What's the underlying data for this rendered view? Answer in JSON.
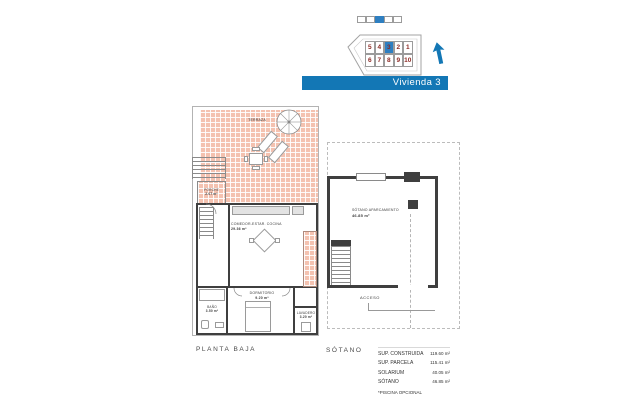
{
  "site_overview": {
    "units_top": [
      "5",
      "4",
      "3",
      "2",
      "1"
    ],
    "units_bottom": [
      "6",
      "7",
      "8",
      "9",
      "10"
    ],
    "highlighted_unit": "3"
  },
  "banner": {
    "label": "Vivienda 3"
  },
  "colors": {
    "accent_blue": "#1377b5",
    "highlight_blue": "#2e7fc1",
    "plot_number_red": "#8c2a24",
    "terrace_hatch": "#f4c2b0",
    "wall_gray": "#3f3f3f"
  },
  "planta_baja": {
    "title": "PLANTA BAJA",
    "terraza_label": "TERRAZA",
    "porche": {
      "name": "PORCHE",
      "area": "2.07 m²"
    },
    "salon": {
      "name": "COMEDOR-ESTAR. COCINA",
      "area": "29.36 m²"
    },
    "dormitorio": {
      "name": "DORMITORIO",
      "area": "9.20 m²"
    },
    "bano": {
      "name": "BAÑO",
      "area": "3.50 m²"
    },
    "lavadero": {
      "name": "LAVADERO",
      "area": "3.20 m²"
    }
  },
  "sotano": {
    "title": "SÓTANO",
    "room": {
      "name": "SÓTANO APARCAMIENTO",
      "area": "46.85 m²"
    },
    "acceso_label": "ACCESO"
  },
  "summary": {
    "rows": [
      {
        "label": "SUP. CONSTRUIDA",
        "value": "119.60 m²"
      },
      {
        "label": "SUP. PARCELA",
        "value": "115.41 m²"
      },
      {
        "label": "SOLARIUM",
        "value": "40.05 m²"
      },
      {
        "label": "SÓTANO",
        "value": "46.85 m²"
      }
    ],
    "footnote": "*PISCINA OPCIONAL"
  }
}
